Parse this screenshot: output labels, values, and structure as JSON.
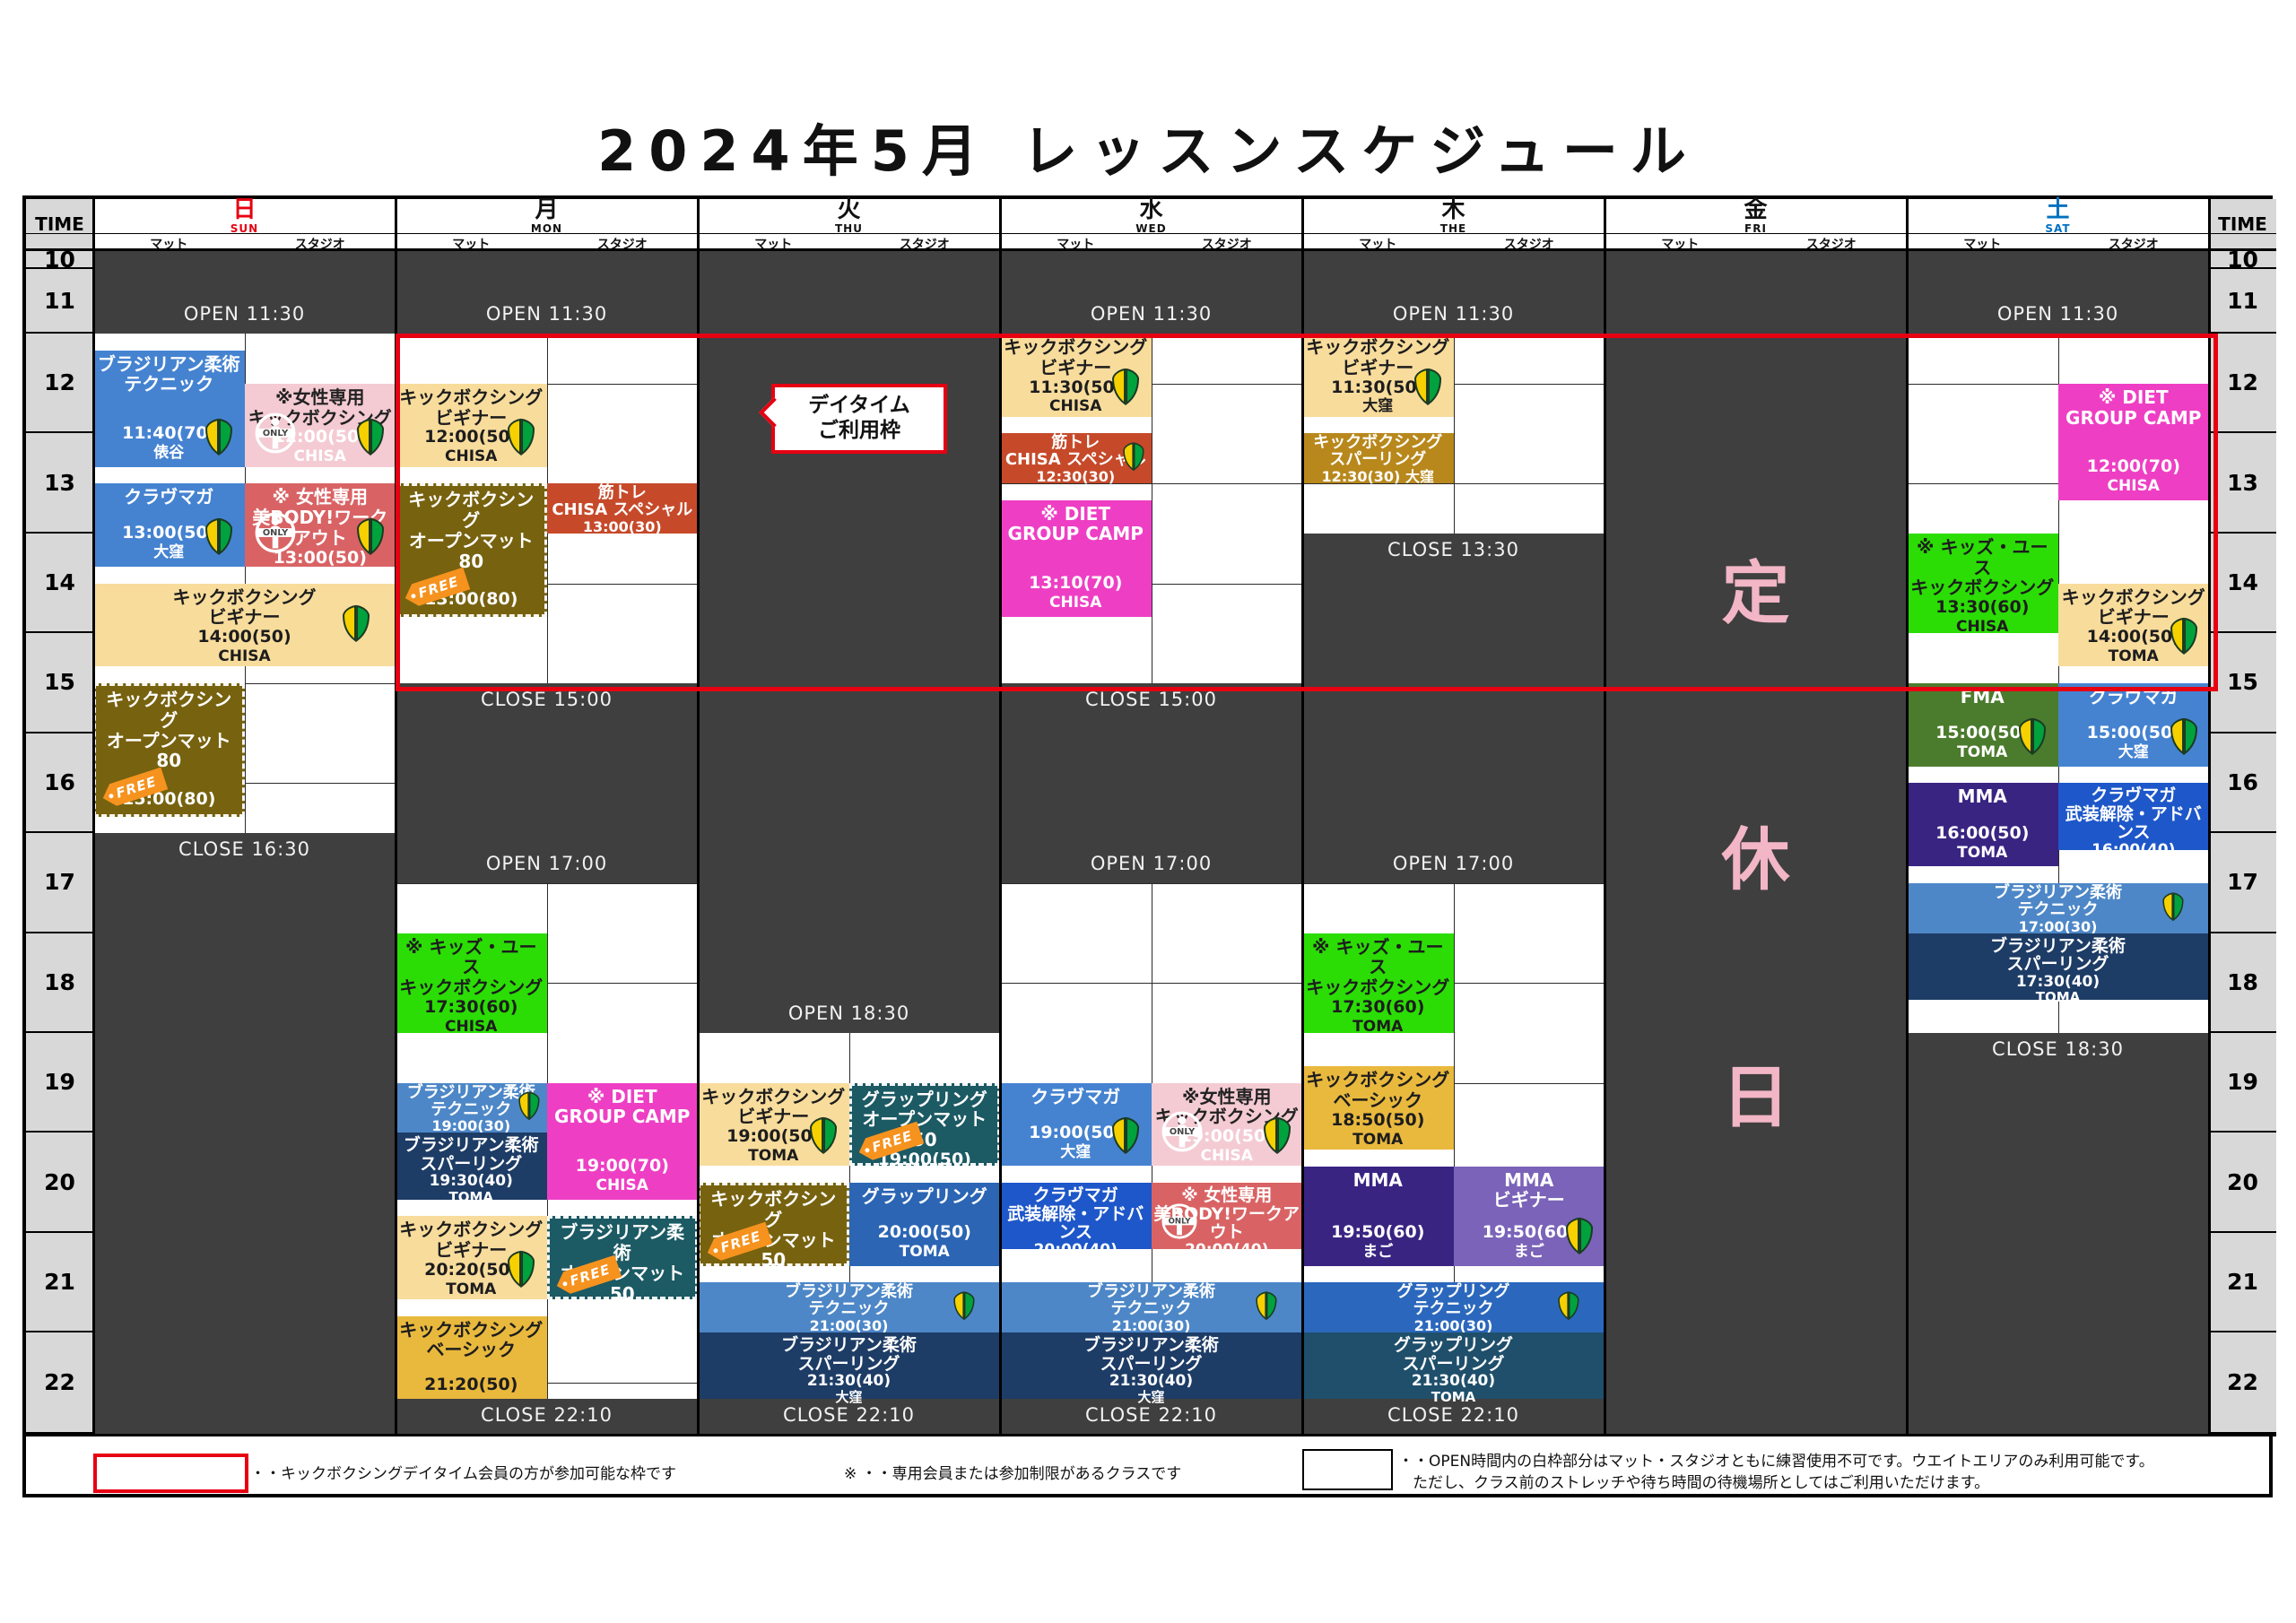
{
  "title": "2024年5月 レッスンスケジュール",
  "time_axis": {
    "label": "TIME",
    "hours": [
      10,
      11,
      12,
      13,
      14,
      15,
      16,
      17,
      18,
      19,
      20,
      21,
      22
    ]
  },
  "areas": {
    "mat": "マット",
    "studio": "スタジオ"
  },
  "icons": {
    "free_label": "FREE",
    "only_label": "ONLY"
  },
  "callout": {
    "line1": "デイタイム",
    "line2": "ご利用枠"
  },
  "holiday": {
    "chars": [
      "定",
      "休",
      "日"
    ]
  },
  "colors": {
    "closed": "#3f3f3f",
    "gutter": "#d8d8d8",
    "frame_red": "#e60012",
    "sun_red": "#e60012",
    "sat_blue": "#0070c0",
    "weekday": "#111111",
    "yellow": "#f8dc9c",
    "gold": "#e9b93e",
    "mustard": "#b8881c",
    "olive": "#77620f",
    "teal": "#1c5a64",
    "redorange": "#c64a2a",
    "magenta": "#ee3fc4",
    "pink": "#f4cbd3",
    "salmon": "#d96364",
    "blue_mid": "#4583d1",
    "blue_strong": "#1e57c9",
    "blue_tech": "#4d87c7",
    "navy": "#1d3c66",
    "grap_blue": "#2b65b4",
    "grap_tech": "#2b68bd",
    "grap_navy": "#1f4f6b",
    "green": "#2bdd05",
    "fma": "#4b7b2d",
    "mma_dark": "#392482",
    "mma_light": "#7a63b8",
    "holiday_pink": "#f2b6c6"
  },
  "legend": {
    "red_note": "・・キックボクシングデイタイム会員の方が参加可能な枠です",
    "star_note": "※ ・・専用会員または参加制限があるクラスです",
    "white_note_1": "・・OPEN時間内の白枠部分はマット・スタジオともに練習使用不可です。ウエイトエリアのみ利用可能です。",
    "white_note_2": "ただし、クラス前のストレッチや待ち時間の待機場所としてはご利用いただけます。"
  },
  "days": [
    {
      "id": "sun",
      "jp": "日",
      "en": "SUN",
      "color": "#e60012",
      "closed": [
        [
          "top",
          "11:30"
        ],
        [
          "16:30",
          "end"
        ]
      ],
      "status": [
        {
          "text": "OPEN 11:30",
          "time": "11:30",
          "type": "open"
        },
        {
          "text": "CLOSE 16:30",
          "time": "16:30",
          "type": "close"
        }
      ],
      "classes": [
        {
          "area": "mat",
          "start": "11:40",
          "dur": 70,
          "color": "blue_mid",
          "lines": [
            "ブラジリアン柔術",
            "テクニック"
          ],
          "time": "11:40(70)",
          "who": "俵谷",
          "icons": [
            "beginner"
          ]
        },
        {
          "area": "studio",
          "start": "12:00",
          "dur": 50,
          "color": "pink",
          "tdark": true,
          "lines": [
            "※女性専用",
            "キックボクシング"
          ],
          "time": "12:00(50)",
          "who": "CHISA",
          "icons": [
            "only",
            "beginner"
          ]
        },
        {
          "area": "mat",
          "start": "13:00",
          "dur": 50,
          "color": "blue_mid",
          "lines": [
            "クラヴマガ"
          ],
          "time": "13:00(50)",
          "who": "大窪",
          "icons": [
            "beginner"
          ]
        },
        {
          "area": "studio",
          "start": "13:00",
          "dur": 50,
          "color": "salmon",
          "lines": [
            "※ 女性専用",
            "美BODY!ワークアウト"
          ],
          "time": "13:00(50)",
          "who": "CHISA",
          "icons": [
            "only",
            "beginner"
          ]
        },
        {
          "area": "both",
          "start": "14:00",
          "dur": 50,
          "color": "yellow",
          "dark": true,
          "lines": [
            "キックボクシング",
            "ビギナー"
          ],
          "time": "14:00(50)",
          "who": "CHISA",
          "icons": [
            "beginner"
          ]
        },
        {
          "area": "mat",
          "start": "15:00",
          "dur": 80,
          "color": "olive",
          "dashed": true,
          "lines": [
            "キックボクシング",
            "オープンマット80"
          ],
          "time": "15:00(80)",
          "icons": [
            "free"
          ]
        }
      ]
    },
    {
      "id": "mon",
      "jp": "月",
      "en": "MON",
      "color": "#111111",
      "closed": [
        [
          "top",
          "11:30"
        ],
        [
          "15:00",
          "17:00"
        ],
        [
          "22:10",
          "end"
        ]
      ],
      "status": [
        {
          "text": "OPEN 11:30",
          "time": "11:30",
          "type": "open"
        },
        {
          "text": "CLOSE 15:00",
          "time": "15:00",
          "type": "close"
        },
        {
          "text": "OPEN 17:00",
          "time": "17:00",
          "type": "open"
        },
        {
          "text": "CLOSE 22:10",
          "time": "22:10",
          "type": "close"
        }
      ],
      "classes": [
        {
          "area": "mat",
          "start": "12:00",
          "dur": 50,
          "color": "yellow",
          "dark": true,
          "lines": [
            "キックボクシング",
            "ビギナー"
          ],
          "time": "12:00(50)",
          "who": "CHISA",
          "icons": [
            "beginner"
          ]
        },
        {
          "area": "mat",
          "start": "13:00",
          "dur": 80,
          "color": "olive",
          "dashed": true,
          "lines": [
            "キックボクシング",
            "オープンマット80"
          ],
          "time": "13:00(80)",
          "icons": [
            "free"
          ]
        },
        {
          "area": "studio",
          "start": "13:00",
          "dur": 30,
          "color": "redorange",
          "lines": [
            "筋トレ",
            "CHISA スペシャル"
          ],
          "time": "13:00(30)"
        },
        {
          "area": "mat",
          "start": "17:30",
          "dur": 60,
          "color": "green",
          "dark": true,
          "lines": [
            "※ キッズ・ユース",
            "キックボクシング"
          ],
          "time": "17:30(60)",
          "who": "CHISA"
        },
        {
          "area": "mat",
          "start": "19:00",
          "dur": 30,
          "color": "blue_tech",
          "lines": [
            "ブラジリアン柔術",
            "テクニック"
          ],
          "time": "19:00(30)",
          "icons": [
            "beginner"
          ]
        },
        {
          "area": "mat",
          "start": "19:30",
          "dur": 40,
          "color": "navy",
          "lines": [
            "ブラジリアン柔術",
            "スパーリング"
          ],
          "time": "19:30(40)",
          "who": "TOMA"
        },
        {
          "area": "studio",
          "start": "19:00",
          "dur": 70,
          "color": "magenta",
          "lines": [
            "※ DIET",
            "GROUP CAMP"
          ],
          "time": "19:00(70)",
          "who": "CHISA"
        },
        {
          "area": "mat",
          "start": "20:20",
          "dur": 50,
          "color": "yellow",
          "dark": true,
          "lines": [
            "キックボクシング",
            "ビギナー"
          ],
          "time": "20:20(50)",
          "who": "TOMA",
          "icons": [
            "beginner"
          ]
        },
        {
          "area": "studio",
          "start": "20:20",
          "dur": 50,
          "color": "teal",
          "dashed": true,
          "lines": [
            "ブラジリアン柔術",
            "オープンマット 50"
          ],
          "time": "19:00(50)",
          "icons": [
            "free"
          ]
        },
        {
          "area": "mat",
          "start": "21:20",
          "dur": 50,
          "color": "gold",
          "dark": true,
          "lines": [
            "キックボクシング",
            "ベーシック"
          ],
          "time": "21:20(50)"
        }
      ]
    },
    {
      "id": "tue",
      "jp": "火",
      "en": "THU",
      "color": "#111111",
      "closed": [
        [
          "top",
          "18:30"
        ],
        [
          "22:10",
          "end"
        ]
      ],
      "status": [
        {
          "text": "OPEN 18:30",
          "time": "18:30",
          "type": "open"
        },
        {
          "text": "CLOSE 22:10",
          "time": "22:10",
          "type": "close"
        }
      ],
      "classes": [
        {
          "area": "mat",
          "start": "19:00",
          "dur": 50,
          "color": "yellow",
          "dark": true,
          "lines": [
            "キックボクシング",
            "ビギナー"
          ],
          "time": "19:00(50)",
          "who": "TOMA",
          "icons": [
            "beginner"
          ]
        },
        {
          "area": "studio",
          "start": "19:00",
          "dur": 50,
          "color": "teal",
          "dashed": true,
          "lines": [
            "グラップリング",
            "オープンマット 50"
          ],
          "time": "19:00(50)",
          "icons": [
            "free"
          ]
        },
        {
          "area": "mat",
          "start": "20:00",
          "dur": 50,
          "color": "olive",
          "dashed": true,
          "lines": [
            "キックボクシング",
            "オープンマット50"
          ],
          "time": "20:00(50)",
          "icons": [
            "free"
          ]
        },
        {
          "area": "studio",
          "start": "20:00",
          "dur": 50,
          "color": "grap_blue",
          "lines": [
            "グラップリング"
          ],
          "time": "20:00(50)",
          "who": "TOMA"
        },
        {
          "area": "both",
          "start": "21:00",
          "dur": 30,
          "color": "blue_tech",
          "lines": [
            "ブラジリアン柔術",
            "テクニック"
          ],
          "time": "21:00(30)",
          "icons": [
            "beginner"
          ]
        },
        {
          "area": "both",
          "start": "21:30",
          "dur": 40,
          "color": "navy",
          "lines": [
            "ブラジリアン柔術",
            "スパーリング"
          ],
          "time": "21:30(40)",
          "who": "大窪"
        }
      ]
    },
    {
      "id": "wed",
      "jp": "水",
      "en": "WED",
      "color": "#111111",
      "closed": [
        [
          "top",
          "11:30"
        ],
        [
          "15:00",
          "17:00"
        ],
        [
          "22:10",
          "end"
        ]
      ],
      "status": [
        {
          "text": "OPEN 11:30",
          "time": "11:30",
          "type": "open"
        },
        {
          "text": "CLOSE 15:00",
          "time": "15:00",
          "type": "close"
        },
        {
          "text": "OPEN 17:00",
          "time": "17:00",
          "type": "open"
        },
        {
          "text": "CLOSE 22:10",
          "time": "22:10",
          "type": "close"
        }
      ],
      "classes": [
        {
          "area": "mat",
          "start": "11:30",
          "dur": 50,
          "color": "yellow",
          "dark": true,
          "lines": [
            "キックボクシング",
            "ビギナー"
          ],
          "time": "11:30(50)",
          "who": "CHISA",
          "icons": [
            "beginner"
          ]
        },
        {
          "area": "mat",
          "start": "12:30",
          "dur": 30,
          "color": "redorange",
          "lines": [
            "筋トレ",
            "CHISA スペシャル"
          ],
          "time": "12:30(30)",
          "icons": [
            "beginner"
          ]
        },
        {
          "area": "mat",
          "start": "13:10",
          "dur": 70,
          "color": "magenta",
          "lines": [
            "※ DIET",
            "GROUP CAMP"
          ],
          "time": "13:10(70)",
          "who": "CHISA"
        },
        {
          "area": "mat",
          "start": "19:00",
          "dur": 50,
          "color": "blue_mid",
          "lines": [
            "クラヴマガ"
          ],
          "time": "19:00(50)",
          "who": "大窪",
          "icons": [
            "beginner"
          ]
        },
        {
          "area": "studio",
          "start": "19:00",
          "dur": 50,
          "color": "pink",
          "tdark": true,
          "lines": [
            "※女性専用",
            "キックボクシング"
          ],
          "time": "19:00(50)",
          "who": "CHISA",
          "icons": [
            "only",
            "beginner"
          ]
        },
        {
          "area": "mat",
          "start": "20:00",
          "dur": 40,
          "color": "blue_strong",
          "lines": [
            "クラヴマガ",
            "武装解除・アドバンス"
          ],
          "time": "20:00(40)",
          "who": "大窪"
        },
        {
          "area": "studio",
          "start": "20:00",
          "dur": 40,
          "color": "salmon",
          "lines": [
            "※ 女性専用",
            "美BODY!ワークアウト"
          ],
          "time": "20:00(40)",
          "who": "CHISA",
          "icons": [
            "only"
          ]
        },
        {
          "area": "both",
          "start": "21:00",
          "dur": 30,
          "color": "blue_tech",
          "lines": [
            "ブラジリアン柔術",
            "テクニック"
          ],
          "time": "21:00(30)",
          "icons": [
            "beginner"
          ]
        },
        {
          "area": "both",
          "start": "21:30",
          "dur": 40,
          "color": "navy",
          "lines": [
            "ブラジリアン柔術",
            "スパーリング"
          ],
          "time": "21:30(40)",
          "who": "大窪"
        }
      ]
    },
    {
      "id": "thu",
      "jp": "木",
      "en": "THE",
      "color": "#111111",
      "closed": [
        [
          "top",
          "11:30"
        ],
        [
          "13:30",
          "17:00"
        ],
        [
          "22:10",
          "end"
        ]
      ],
      "status": [
        {
          "text": "OPEN 11:30",
          "time": "11:30",
          "type": "open"
        },
        {
          "text": "CLOSE 13:30",
          "time": "13:30",
          "type": "close"
        },
        {
          "text": "OPEN 17:00",
          "time": "17:00",
          "type": "open"
        },
        {
          "text": "CLOSE 22:10",
          "time": "22:10",
          "type": "close"
        }
      ],
      "classes": [
        {
          "area": "mat",
          "start": "11:30",
          "dur": 50,
          "color": "yellow",
          "dark": true,
          "lines": [
            "キックボクシング",
            "ビギナー"
          ],
          "time": "11:30(50)",
          "who": "大窪",
          "icons": [
            "beginner"
          ]
        },
        {
          "area": "mat",
          "start": "12:30",
          "dur": 30,
          "color": "mustard",
          "lines": [
            "キックボクシング",
            "スパーリング"
          ],
          "time": "12:30(30)",
          "who": "大窪"
        },
        {
          "area": "mat",
          "start": "17:30",
          "dur": 60,
          "color": "green",
          "dark": true,
          "lines": [
            "※ キッズ・ユース",
            "キックボクシング"
          ],
          "time": "17:30(60)",
          "who": "TOMA"
        },
        {
          "area": "mat",
          "start": "18:50",
          "dur": 50,
          "color": "gold",
          "dark": true,
          "lines": [
            "キックボクシング",
            "ベーシック"
          ],
          "time": "18:50(50)",
          "who": "TOMA"
        },
        {
          "area": "mat",
          "start": "19:50",
          "dur": 60,
          "color": "mma_dark",
          "lines": [
            "MMA"
          ],
          "time": "19:50(60)",
          "who": "まご"
        },
        {
          "area": "studio",
          "start": "19:50",
          "dur": 60,
          "color": "mma_light",
          "lines": [
            "MMA",
            "ビギナー"
          ],
          "time": "19:50(60)",
          "who": "まご",
          "icons": [
            "beginner"
          ]
        },
        {
          "area": "both",
          "start": "21:00",
          "dur": 30,
          "color": "grap_tech",
          "lines": [
            "グラップリング",
            "テクニック"
          ],
          "time": "21:00(30)",
          "icons": [
            "beginner"
          ]
        },
        {
          "area": "both",
          "start": "21:30",
          "dur": 40,
          "color": "grap_navy",
          "lines": [
            "グラップリング",
            "スパーリング"
          ],
          "time": "21:30(40)",
          "who": "TOMA"
        }
      ]
    },
    {
      "id": "fri",
      "jp": "金",
      "en": "FRI",
      "color": "#111111",
      "closed": [
        [
          "top",
          "end"
        ]
      ],
      "status": [],
      "holiday": true,
      "classes": []
    },
    {
      "id": "sat",
      "jp": "土",
      "en": "SAT",
      "color": "#0070c0",
      "closed": [
        [
          "top",
          "11:30"
        ],
        [
          "18:30",
          "end"
        ]
      ],
      "status": [
        {
          "text": "OPEN 11:30",
          "time": "11:30",
          "type": "open"
        },
        {
          "text": "CLOSE 18:30",
          "time": "18:30",
          "type": "close"
        }
      ],
      "classes": [
        {
          "area": "studio",
          "start": "12:00",
          "dur": 70,
          "color": "magenta",
          "lines": [
            "※ DIET",
            "GROUP CAMP"
          ],
          "time": "12:00(70)",
          "who": "CHISA"
        },
        {
          "area": "mat",
          "start": "13:30",
          "dur": 60,
          "color": "green",
          "dark": true,
          "lines": [
            "※ キッズ・ユース",
            "キックボクシング"
          ],
          "time": "13:30(60)",
          "who": "CHISA"
        },
        {
          "area": "studio",
          "start": "14:00",
          "dur": 50,
          "color": "yellow",
          "dark": true,
          "lines": [
            "キックボクシング",
            "ビギナー"
          ],
          "time": "14:00(50)",
          "who": "TOMA",
          "icons": [
            "beginner"
          ]
        },
        {
          "area": "mat",
          "start": "15:00",
          "dur": 50,
          "color": "fma",
          "lines": [
            "FMA"
          ],
          "time": "15:00(50)",
          "who": "TOMA",
          "icons": [
            "beginner"
          ]
        },
        {
          "area": "studio",
          "start": "15:00",
          "dur": 50,
          "color": "blue_mid",
          "lines": [
            "クラヴマガ"
          ],
          "time": "15:00(50)",
          "who": "大窪",
          "icons": [
            "beginner"
          ]
        },
        {
          "area": "mat",
          "start": "16:00",
          "dur": 50,
          "color": "mma_dark",
          "lines": [
            "MMA"
          ],
          "time": "16:00(50)",
          "who": "TOMA"
        },
        {
          "area": "studio",
          "start": "16:00",
          "dur": 40,
          "color": "blue_strong",
          "lines": [
            "クラヴマガ",
            "武装解除・アドバンス"
          ],
          "time": "16:00(40)",
          "who": "大窪"
        },
        {
          "area": "both",
          "start": "17:00",
          "dur": 30,
          "color": "blue_tech",
          "lines": [
            "ブラジリアン柔術",
            "テクニック"
          ],
          "time": "17:00(30)",
          "icons": [
            "beginner"
          ]
        },
        {
          "area": "both",
          "start": "17:30",
          "dur": 40,
          "color": "navy",
          "lines": [
            "ブラジリアン柔術",
            "スパーリング"
          ],
          "time": "17:30(40)",
          "who": "TOMA"
        }
      ]
    }
  ]
}
